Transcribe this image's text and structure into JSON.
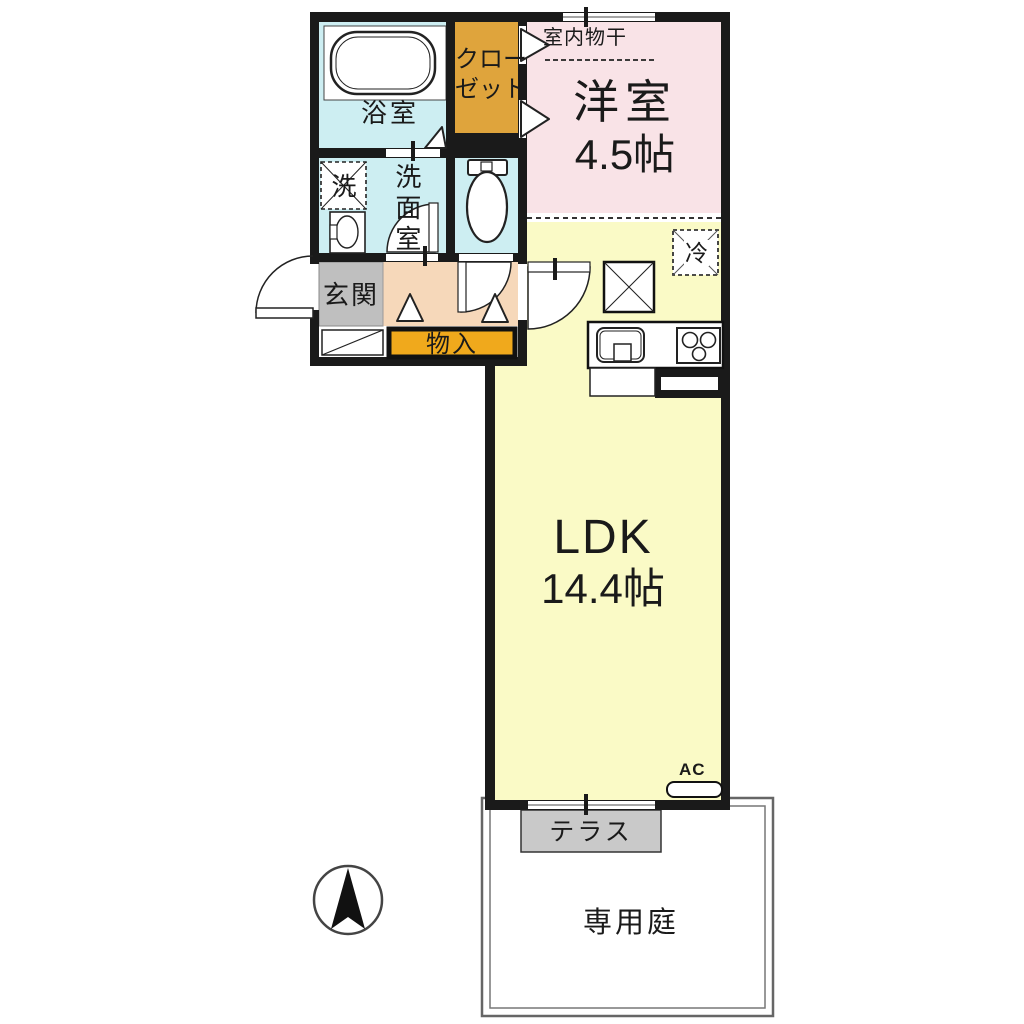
{
  "floorplan": {
    "western_room": {
      "name": "洋室",
      "size": "4.5帖"
    },
    "ldk": {
      "name": "LDK",
      "size": "14.4帖"
    },
    "indoor_drying_label": "室内物干",
    "closet": {
      "line1": "クロー",
      "line2": "ゼット"
    },
    "bathroom_label": "浴室",
    "washer_label": "洗",
    "washroom_label": "洗面室",
    "entrance_label": "玄関",
    "storage_label": "物入",
    "refrigerator_label": "冷",
    "ac_label": "AC",
    "terrace_label": "テラス",
    "garden_label": "専用庭",
    "colors": {
      "western_room": "#f9e3e7",
      "ldk": "#fafac6",
      "wet_rooms": "#cdeef2",
      "hallway": "#f6d8ba",
      "closet": "#dfa43c",
      "storage": "#f0a91c",
      "entrance_floor": "#bfbfbf",
      "terrace": "#c9c9c9",
      "wall": "#1a1a1a"
    }
  }
}
